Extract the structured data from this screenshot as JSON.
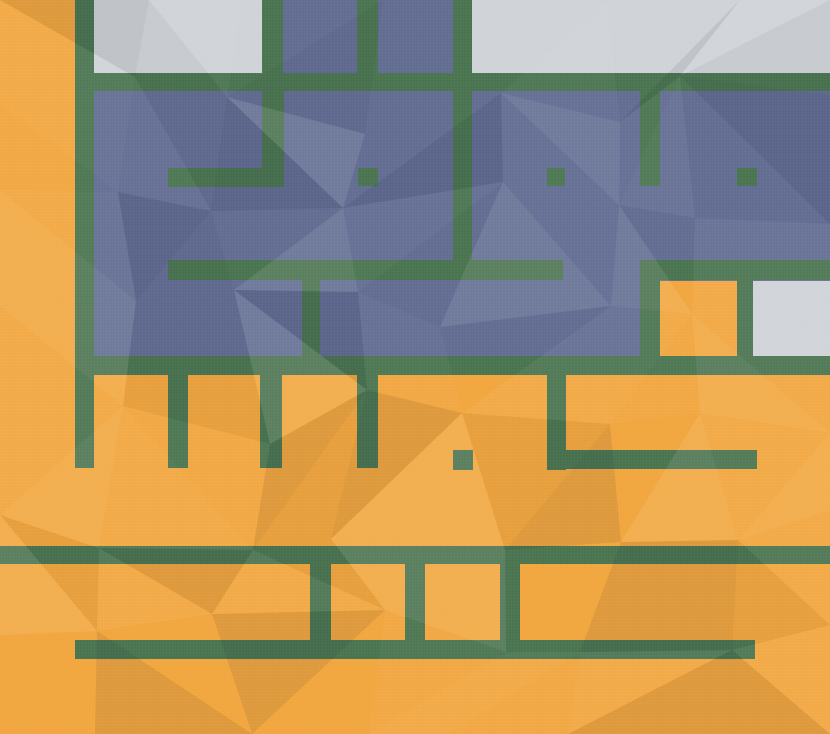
{
  "canvas": {
    "width": 830,
    "height": 734
  },
  "palette": {
    "ground_orange": "#F1A63E",
    "wall_green": "#4A7450",
    "room_blue": "#626D92",
    "room_gray": "#CFD3D7"
  },
  "map": {
    "base_color": "ground_orange",
    "regions": [
      {
        "name": "gray-room-top-left",
        "color": "room_gray",
        "x": 94,
        "y": 0,
        "w": 168,
        "h": 73
      },
      {
        "name": "gray-room-top-right",
        "color": "room_gray",
        "x": 472,
        "y": 0,
        "w": 358,
        "h": 73
      },
      {
        "name": "blue-room-top-a",
        "color": "room_blue",
        "x": 283,
        "y": 0,
        "w": 74,
        "h": 73
      },
      {
        "name": "blue-room-top-b",
        "color": "room_blue",
        "x": 378,
        "y": 0,
        "w": 75,
        "h": 73
      },
      {
        "name": "blue-room-main",
        "color": "room_blue",
        "x": 94,
        "y": 91,
        "w": 736,
        "h": 265
      },
      {
        "name": "orange-cell-in-blue",
        "color": "ground_orange",
        "x": 660,
        "y": 281,
        "w": 77,
        "h": 75
      },
      {
        "name": "gray-room-mid-right",
        "color": "room_gray",
        "x": 753,
        "y": 281,
        "w": 77,
        "h": 75
      },
      {
        "name": "wall-left-vertical",
        "color": "wall_green",
        "x": 75,
        "y": 0,
        "w": 19,
        "h": 468
      },
      {
        "name": "wall-top-band",
        "color": "wall_green",
        "x": 75,
        "y": 73,
        "w": 755,
        "h": 18
      },
      {
        "name": "wall-top-stub-1",
        "color": "wall_green",
        "x": 262,
        "y": 0,
        "w": 21,
        "h": 73
      },
      {
        "name": "wall-top-stub-2",
        "color": "wall_green",
        "x": 357,
        "y": 0,
        "w": 21,
        "h": 73
      },
      {
        "name": "wall-top-stub-3",
        "color": "wall_green",
        "x": 453,
        "y": 0,
        "w": 19,
        "h": 73
      },
      {
        "name": "wall-elbow-vertical",
        "color": "wall_green",
        "x": 262,
        "y": 91,
        "w": 22,
        "h": 96
      },
      {
        "name": "wall-elbow-horizontal",
        "color": "wall_green",
        "x": 168,
        "y": 168,
        "w": 116,
        "h": 19
      },
      {
        "name": "wall-dot-a",
        "color": "wall_green",
        "x": 358,
        "y": 168,
        "w": 20,
        "h": 18
      },
      {
        "name": "wall-dot-b",
        "color": "wall_green",
        "x": 547,
        "y": 168,
        "w": 18,
        "h": 18
      },
      {
        "name": "wall-dot-c",
        "color": "wall_green",
        "x": 737,
        "y": 168,
        "w": 20,
        "h": 18
      },
      {
        "name": "wall-mid-vertical-long",
        "color": "wall_green",
        "x": 453,
        "y": 91,
        "w": 19,
        "h": 169
      },
      {
        "name": "wall-mid-vertical-short",
        "color": "wall_green",
        "x": 640,
        "y": 91,
        "w": 20,
        "h": 95
      },
      {
        "name": "wall-band2-left",
        "color": "wall_green",
        "x": 168,
        "y": 260,
        "w": 395,
        "h": 20
      },
      {
        "name": "wall-band2-right",
        "color": "wall_green",
        "x": 640,
        "y": 260,
        "w": 190,
        "h": 20
      },
      {
        "name": "wall-connector-vertical",
        "color": "wall_green",
        "x": 302,
        "y": 280,
        "w": 18,
        "h": 76
      },
      {
        "name": "wall-cell-left",
        "color": "wall_green",
        "x": 640,
        "y": 280,
        "w": 20,
        "h": 76
      },
      {
        "name": "wall-cell-right",
        "color": "wall_green",
        "x": 737,
        "y": 280,
        "w": 16,
        "h": 76
      },
      {
        "name": "wall-band3",
        "color": "wall_green",
        "x": 75,
        "y": 356,
        "w": 755,
        "h": 19
      },
      {
        "name": "wall-hanging-1",
        "color": "wall_green",
        "x": 168,
        "y": 375,
        "w": 20,
        "h": 93
      },
      {
        "name": "wall-hanging-2",
        "color": "wall_green",
        "x": 260,
        "y": 375,
        "w": 22,
        "h": 93
      },
      {
        "name": "wall-hanging-3",
        "color": "wall_green",
        "x": 357,
        "y": 375,
        "w": 21,
        "h": 93
      },
      {
        "name": "wall-dot-d",
        "color": "wall_green",
        "x": 453,
        "y": 450,
        "w": 20,
        "h": 20
      },
      {
        "name": "wall-l-vertical",
        "color": "wall_green",
        "x": 547,
        "y": 375,
        "w": 19,
        "h": 95
      },
      {
        "name": "wall-l-horizontal",
        "color": "wall_green",
        "x": 547,
        "y": 450,
        "w": 210,
        "h": 19
      },
      {
        "name": "wall-bottom-line-1",
        "color": "wall_green",
        "x": 0,
        "y": 546,
        "w": 830,
        "h": 18
      },
      {
        "name": "wall-rung-1",
        "color": "wall_green",
        "x": 310,
        "y": 564,
        "w": 21,
        "h": 76
      },
      {
        "name": "wall-rung-2",
        "color": "wall_green",
        "x": 405,
        "y": 564,
        "w": 20,
        "h": 76
      },
      {
        "name": "wall-rung-3",
        "color": "wall_green",
        "x": 500,
        "y": 564,
        "w": 20,
        "h": 76
      },
      {
        "name": "wall-bottom-line-2",
        "color": "wall_green",
        "x": 75,
        "y": 640,
        "w": 680,
        "h": 19
      }
    ]
  }
}
